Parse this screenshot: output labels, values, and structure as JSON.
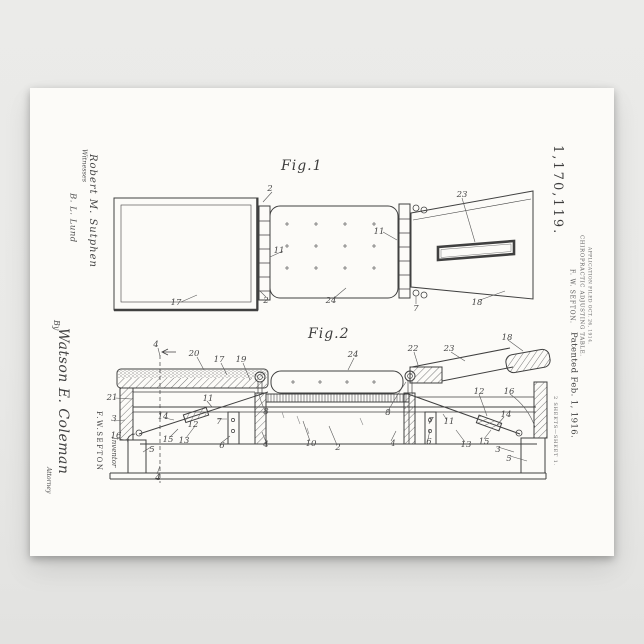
{
  "poster": {
    "patent_number": "1,170,119.",
    "inventor_line": "F. W. SEFTON.",
    "title_line": "CHIROPRACTIC ADJUSTING TABLE.",
    "application_line": "APPLICATION FILED OCT. 26, 1914.",
    "patented_line": "Patented Feb. 1, 1916.",
    "sheet_line": "2 SHEETS—SHEET 1.",
    "witnesses": {
      "label": "Witnesses",
      "signatures": [
        "Robert M. Sutphen",
        "B. L. Lund"
      ]
    },
    "by_label": "By",
    "attorney_signature": "Watson E. Coleman",
    "attorney_label": "Attorney",
    "inventor_name": "F.W.SEFTON",
    "inventor_label": "Inventor",
    "figures": [
      {
        "label": "Fig.1",
        "callouts": [
          {
            "t": "2",
            "x": 270,
            "y": 189
          },
          {
            "t": "17",
            "x": 176,
            "y": 303
          },
          {
            "t": "2",
            "x": 266,
            "y": 301
          },
          {
            "t": "11",
            "x": 279,
            "y": 251
          },
          {
            "t": "11",
            "x": 379,
            "y": 232
          },
          {
            "t": "24",
            "x": 331,
            "y": 301
          },
          {
            "t": "23",
            "x": 462,
            "y": 195
          },
          {
            "t": "18",
            "x": 477,
            "y": 303
          },
          {
            "t": "7",
            "x": 416,
            "y": 309
          }
        ]
      },
      {
        "label": "Fig.2",
        "callouts": [
          {
            "t": "4",
            "x": 156,
            "y": 345
          },
          {
            "t": "20",
            "x": 194,
            "y": 354
          },
          {
            "t": "17",
            "x": 219,
            "y": 360
          },
          {
            "t": "19",
            "x": 241,
            "y": 360
          },
          {
            "t": "24",
            "x": 353,
            "y": 355
          },
          {
            "t": "22",
            "x": 413,
            "y": 349
          },
          {
            "t": "23",
            "x": 449,
            "y": 349
          },
          {
            "t": "18",
            "x": 507,
            "y": 338
          },
          {
            "t": "21",
            "x": 112,
            "y": 398
          },
          {
            "t": "3",
            "x": 114,
            "y": 419
          },
          {
            "t": "16",
            "x": 116,
            "y": 436
          },
          {
            "t": "14",
            "x": 163,
            "y": 417
          },
          {
            "t": "11",
            "x": 208,
            "y": 399
          },
          {
            "t": "12",
            "x": 193,
            "y": 425
          },
          {
            "t": "7",
            "x": 219,
            "y": 422
          },
          {
            "t": "15",
            "x": 168,
            "y": 440
          },
          {
            "t": "13",
            "x": 184,
            "y": 441
          },
          {
            "t": "5",
            "x": 152,
            "y": 450
          },
          {
            "t": "6",
            "x": 222,
            "y": 446
          },
          {
            "t": "4",
            "x": 158,
            "y": 478
          },
          {
            "t": "8",
            "x": 266,
            "y": 412
          },
          {
            "t": "8",
            "x": 388,
            "y": 413
          },
          {
            "t": "4",
            "x": 266,
            "y": 445
          },
          {
            "t": "10",
            "x": 311,
            "y": 444
          },
          {
            "t": "2",
            "x": 338,
            "y": 448
          },
          {
            "t": "4",
            "x": 393,
            "y": 444
          },
          {
            "t": "12",
            "x": 479,
            "y": 392
          },
          {
            "t": "16",
            "x": 509,
            "y": 392
          },
          {
            "t": "7",
            "x": 431,
            "y": 421
          },
          {
            "t": "11",
            "x": 449,
            "y": 422
          },
          {
            "t": "14",
            "x": 506,
            "y": 415
          },
          {
            "t": "6",
            "x": 429,
            "y": 442
          },
          {
            "t": "13",
            "x": 466,
            "y": 445
          },
          {
            "t": "15",
            "x": 484,
            "y": 442
          },
          {
            "t": "3",
            "x": 498,
            "y": 450
          },
          {
            "t": "5",
            "x": 509,
            "y": 459
          }
        ]
      }
    ]
  },
  "colors": {
    "ink": "#404040",
    "paper": "#fcfbf8",
    "mat": "#e9e9e7"
  }
}
